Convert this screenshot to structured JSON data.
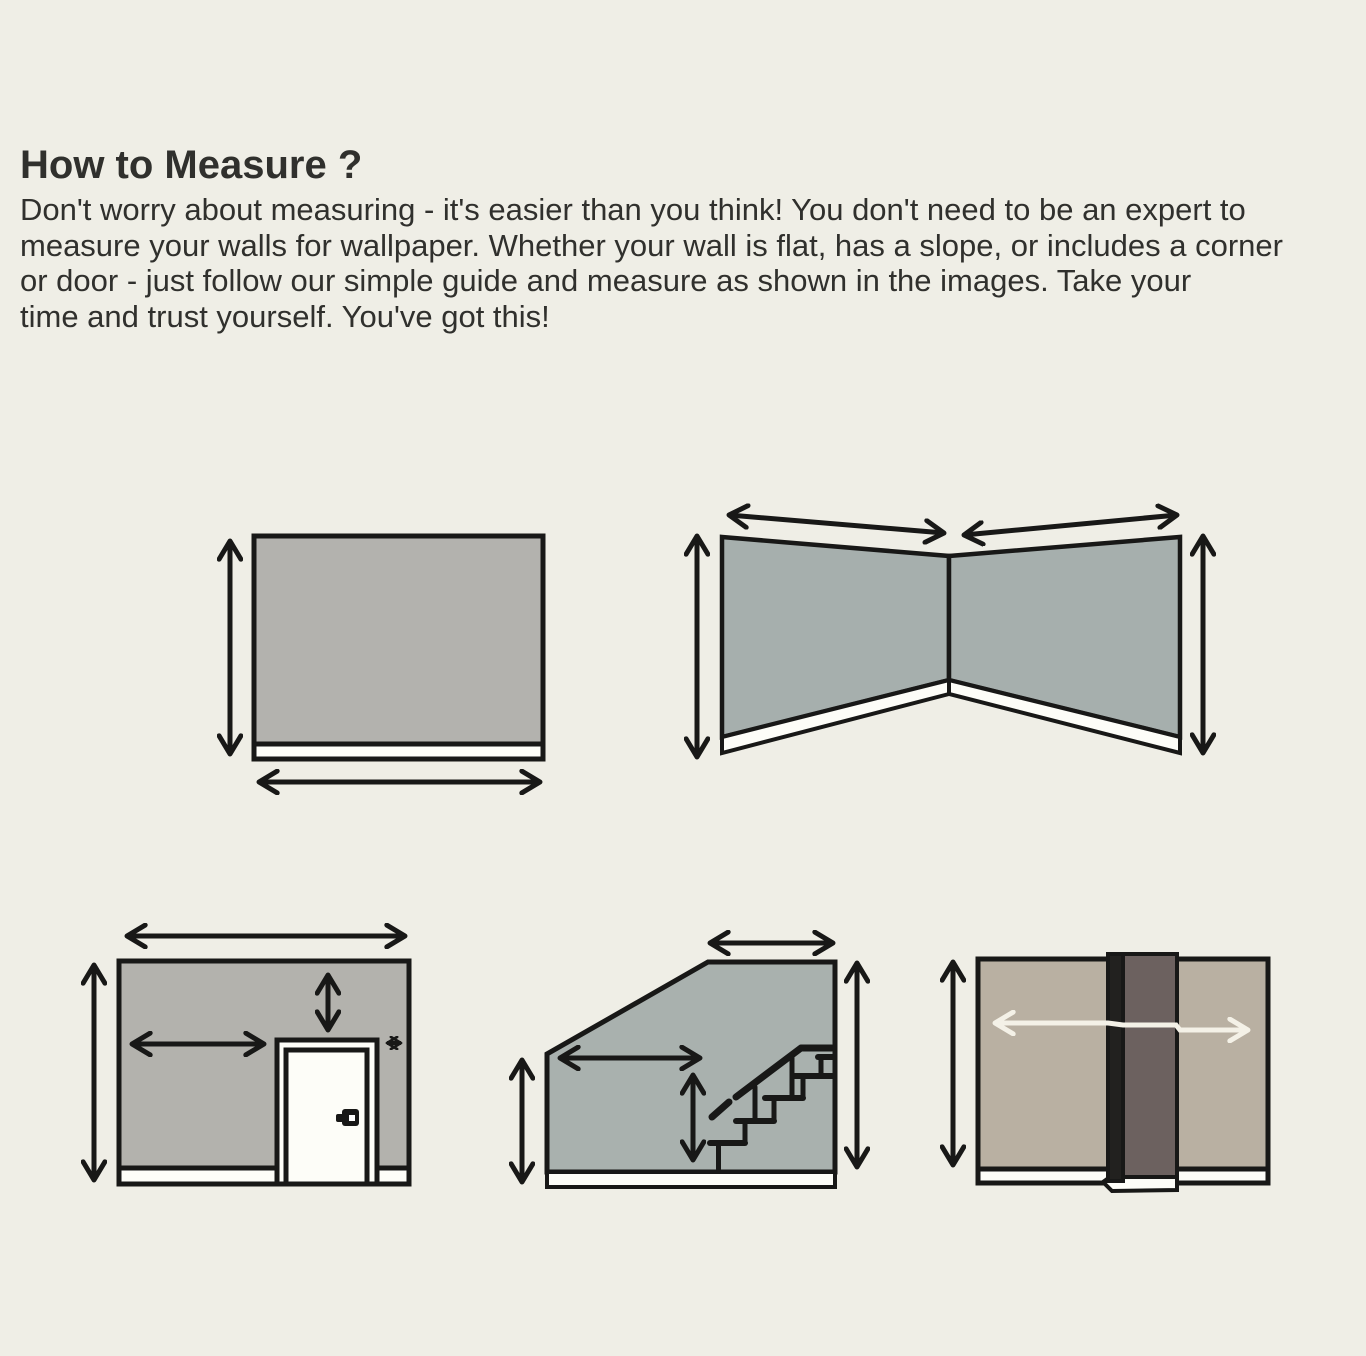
{
  "header": {
    "title": "How to Measure ?",
    "body_lines": [
      "Don't worry about measuring - it's easier than you think! You don't need to be an expert to",
      "measure your walls for wallpaper. Whether your wall is flat, has a slope, or includes a corner",
      "or door - just follow our simple guide and measure as shown in the images. Take your",
      "time and trust yourself. You've got this!"
    ]
  },
  "colors": {
    "background": "#efeee6",
    "text": "#30302d",
    "line": "#181817",
    "flat_wall": "#b3b2ae",
    "corner_wall": "#a6afad",
    "door_wall": "#b3b2ad",
    "stair_wall": "#a9b1ae",
    "column_wall": "#b9b0a2",
    "column_front": "#6c615f",
    "column_side": "#22211f",
    "baseboard": "#fdfdf8",
    "light_arrow": "#f4f1e7"
  },
  "diagrams": [
    {
      "name": "flat-wall"
    },
    {
      "name": "corner-wall"
    },
    {
      "name": "wall-with-door"
    },
    {
      "name": "sloped-wall-with-staircase"
    },
    {
      "name": "wall-with-column"
    }
  ]
}
